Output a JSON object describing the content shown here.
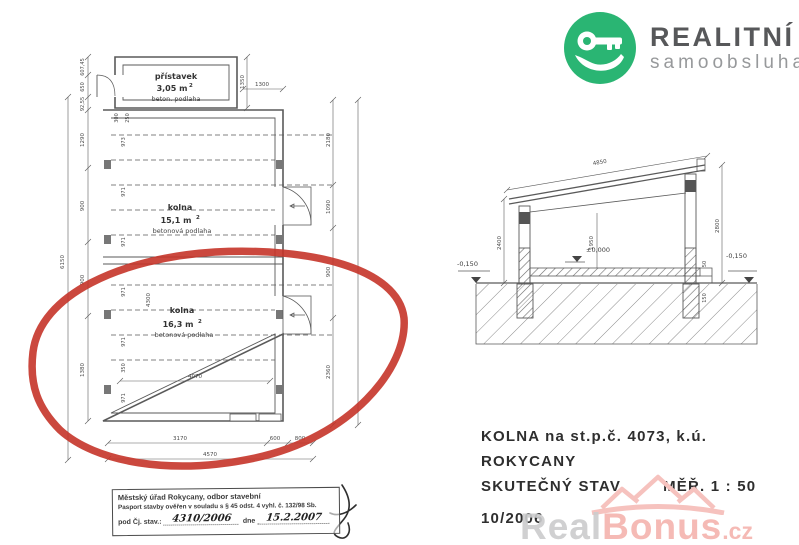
{
  "brand": {
    "name": "REALITNÍ",
    "subtitle": "samoobsluha",
    "green": "#2ab573"
  },
  "plan": {
    "pristavek": {
      "name": "přístavek",
      "area": "3,05 m",
      "area_exp": "2",
      "floor": "beton. podlaha"
    },
    "room1": {
      "name": "kolna",
      "area": "15,1 m",
      "area_exp": "2",
      "floor": "betonová podlaha"
    },
    "room2": {
      "name": "kolna",
      "area": "16,3 m",
      "area_exp": "2",
      "floor": "betonová podlaha"
    },
    "dims": {
      "top_width": "1300",
      "pristavek_height": "1350",
      "left_outer": [
        "607,45",
        "650",
        "92,55",
        "1290",
        "900",
        "900",
        "1380"
      ],
      "left_overall": "6150",
      "inner_left": [
        "973",
        "971",
        "971",
        "971",
        "971",
        "350",
        "971"
      ],
      "inner_top_a": "300",
      "inner_top_b": "250",
      "inner_height": "4300",
      "inner_width": "4070",
      "right": [
        "2180",
        "1090",
        "900",
        "2360"
      ],
      "bottom_segments": [
        "3170",
        "600",
        "800"
      ],
      "bottom_total": "4570"
    }
  },
  "section": {
    "dims": {
      "roof_length": "4850",
      "left_height": "2400",
      "clear_height": "1950",
      "right_height": "2800",
      "floor_level": "±0,000",
      "grade_left": "-0,150",
      "grade_right": "-0,150",
      "gutter_a": "50",
      "gutter_b": "150"
    }
  },
  "caption": {
    "line1": "KOLNA na st.p.č. 4073, k.ú. ROKYCANY",
    "line2_left": "SKUTEČNÝ STAV",
    "line2_right": "MĚŘ. 1 : 50",
    "line3": "10/2006"
  },
  "stamp": {
    "authority": "Městský úřad Rokycany, odbor stavební",
    "statement": "Pasport stavby ověřen v souladu s § 45 odst. 4 vyhl. č. 132/98 Sb.",
    "ref_label": "pod Čj. stav.:",
    "ref_number": "4310/2006",
    "date_label": "dne",
    "date_value": "15.2.2007"
  },
  "watermark": {
    "part1": "Real",
    "part2": "Bonus",
    "tld": ".cz"
  },
  "annotation": {
    "type": "hand-drawn red ellipse",
    "color": "#c53429"
  }
}
